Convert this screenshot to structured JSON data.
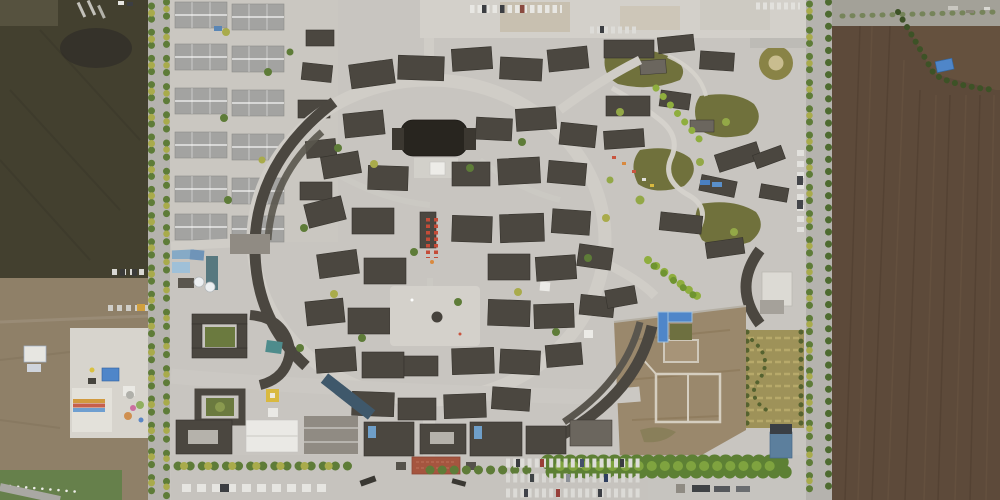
{
  "scene": {
    "type": "aerial-photograph",
    "description": "Top-down drone photograph of a reconstructed traditional Chinese old-town tourist complex. A dense core of dark grey tiled courtyard houses is arranged around an oval ring street with a central plaza. A grid of lighter modern courtyard homes sits at the north-west, landscaped olive-green gardens at the north-east, and a bare earth lot with building foundations at the south-east. Two tree-lined roads frame the complex; dark ploughed farmland lies to the west and east. A small fairground with coloured tents occupies the south-west field, and visitor parking rows with cars line the north edge and south entrance beside a red-paved forecourt."
  },
  "regions": {
    "west_farmland": {
      "label": "dark ploughed field west of the complex"
    },
    "fairground": {
      "label": "small fairground with coloured tents on concrete pad"
    },
    "grass_corner": {
      "label": "green pasture strip at south-west corner"
    },
    "west_road": {
      "label": "tree-lined north-south road, west side"
    },
    "northwest_housing": {
      "label": "grid of light-grey roofed courtyard homes"
    },
    "construction_site": {
      "label": "blue-roofed construction sheds with white tanks"
    },
    "village_core": {
      "label": "dense historic village core of dark tiled roofs"
    },
    "ring_street": {
      "label": "oval ring street with long curved arcade buildings"
    },
    "central_plaza": {
      "label": "central plaza with round well feature"
    },
    "theater_building": {
      "label": "large very dark roofed hall north of centre"
    },
    "market_stalls": {
      "label": "double row of red market stalls"
    },
    "north_parking": {
      "label": "parking strip along the north edge"
    },
    "northeast_gardens": {
      "label": "landscaped gardens with winding paths"
    },
    "crescent_building": {
      "label": "crescent-shaped building at east edge"
    },
    "formal_garden": {
      "label": "striped formal garden plot"
    },
    "pool_courtyard": {
      "label": "blue-edged pool courtyard"
    },
    "southeast_dirt_lot": {
      "label": "bare earth lot with pale building foundations"
    },
    "south_frontage": {
      "label": "entrance frontage buildings along the south"
    },
    "red_plaza": {
      "label": "red paved entrance forecourt"
    },
    "tree_hedge": {
      "label": "dense green tree hedge along the south-east"
    },
    "south_parking": {
      "label": "visitor car park rows with vehicles"
    },
    "east_road": {
      "label": "tree-lined north-south road, east side"
    },
    "east_farmland": {
      "label": "large brown ploughed field east of the road"
    },
    "blue_tarp": {
      "label": "blue tarpaulin in the east field"
    }
  },
  "palette": {
    "base_ground": "#c8c5c0",
    "parking_ground": "#d3d0ca",
    "field_dark": "#43402f",
    "field_dark2": "#35322a",
    "field_light": "#8f8068",
    "field_brown": "#5d4a3a",
    "field_brown_dark": "#4e3c2e",
    "road": "#b5b3ae",
    "roof_dark": "#4b4740",
    "roof_edge": "#36332d",
    "roof_darker": "#28251f",
    "roof_mid": "#6b665e",
    "roof_light": "#a3a3a1",
    "roof_gray": "#908b83",
    "white_roof": "#eae9e5",
    "plaza_light": "#d4d1cb",
    "tree_green": "#5e7c38",
    "tree_yellow": "#a9ab4b",
    "tree_bright": "#8fae3e",
    "hedge_green": "#5d8034",
    "garden_olive": "#70713c",
    "garden_rows": "#9e9259",
    "grass_green": "#66804b",
    "dirt_lot": "#9a886c",
    "red_plaza": "#a5553f",
    "stall_red": "#c44c38",
    "water_blue": "#4f86c9",
    "teal": "#4e8c8c",
    "slate_blue": "#5c7f9d",
    "car_white": "#e6e5e1",
    "car_dark": "#3c3e42"
  }
}
